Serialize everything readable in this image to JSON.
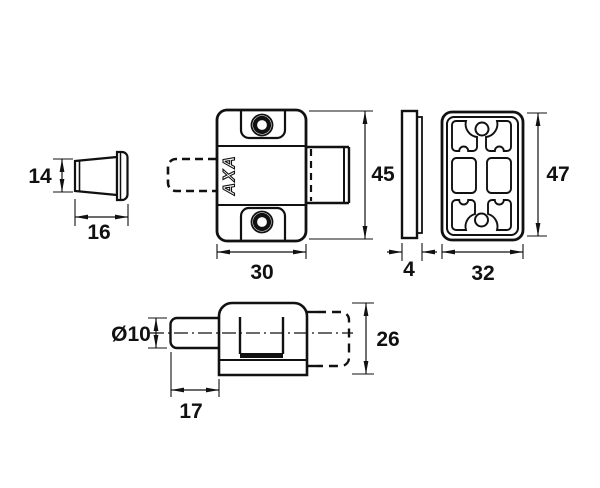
{
  "drawing": {
    "type": "technical-dimension-drawing",
    "background": "#ffffff",
    "ink": "#111111"
  },
  "views": {
    "plug": {
      "dim_height": "14",
      "dim_width": "16"
    },
    "latch_front": {
      "logo": "AXA",
      "dim_width": "30",
      "dim_height": "45"
    },
    "striker_side": {
      "dim_thickness": "4"
    },
    "striker_front": {
      "dim_width": "32",
      "dim_height": "47"
    },
    "latch_bottom": {
      "dim_pin_diameter": "Ø10",
      "dim_pin_length": "17",
      "dim_height": "26"
    }
  }
}
